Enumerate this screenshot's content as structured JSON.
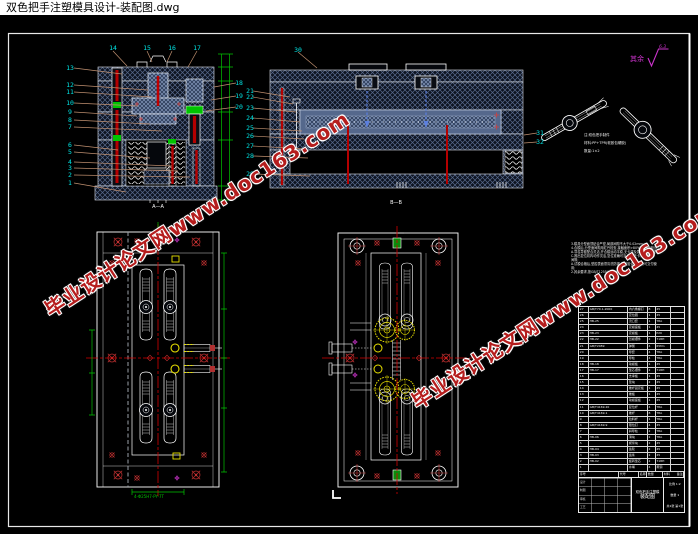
{
  "window": {
    "title": "双色把手注塑模具设计-装配图.dwg"
  },
  "watermark": {
    "text": "毕业设计论文网www.doc163.com"
  },
  "colors": {
    "background": "#000000",
    "titlebar_bg": "#ffffff",
    "hatch_steel": "#56688a",
    "core_blue": "#55688c",
    "callout_cyan": "#00e5e5",
    "leader_tan": "#c09070",
    "dimension_green": "#00c400",
    "centerline_red": "#d40000",
    "bolt_red": "#b40000",
    "slide_yellow": "#e8e000",
    "roughness_magenta": "#cc33cc",
    "watermark_red": "#b51d1d"
  },
  "roughness": {
    "prefix": "其余",
    "value": "6.3"
  },
  "handle_notes": [
    "注:双色把手制件",
    "材料:PP+TPR(软胶包硬胶)",
    "数量:1×2"
  ],
  "view_labels": {
    "front": "A—A",
    "side": "B—B"
  },
  "green_note": "4-Φ25H7-PY-7T",
  "callouts": {
    "left_column": [
      "13",
      "12",
      "11",
      "10",
      "9",
      "8",
      "7",
      "6",
      "5",
      "4",
      "3",
      "2",
      "1"
    ],
    "top_row": [
      "14",
      "15",
      "16",
      "17"
    ],
    "mid_left": [
      "18",
      "19",
      "20"
    ],
    "mid_right": [
      "21",
      "22",
      "23",
      "24",
      "25",
      "26",
      "27",
      "28",
      "29"
    ],
    "side_view_top": "30",
    "side_view_right": [
      "31",
      "32"
    ]
  },
  "tech_notes": {
    "lines": [
      "3.模具分型面须贴合严密,局部间隙不大于0.02mm;",
      "4.合模后,分型面间隙用红丹检查,接触面积>80%(涂红丹检查);",
      "A.导柱导套配合灵活,开合模运动平稳,无卡滞及异常噪音现象;",
      "C.推出复位机构动作灵活,复位准确可靠,推杆无卡滞现象;",
      "  间隙;",
      "A.试模合格后,型腔表面须清洗防锈,经检验合格后 方可交付使",
      "用;",
      "2.其余要求,按GB/T12554-2006执行."
    ]
  },
  "parts_table": {
    "headers": [
      "序号",
      "代号",
      "名称",
      "数量",
      "材料",
      "备注"
    ],
    "rows": [
      [
        "27",
        "GB/T70.1-2000",
        "内六角螺钉",
        "8",
        "45",
        ""
      ],
      [
        "26",
        "",
        "定位圈",
        "1",
        "45",
        ""
      ],
      [
        "25",
        "HB-25",
        "浇口套",
        "1",
        "T8A",
        ""
      ],
      [
        "24",
        "",
        "定模座板",
        "1",
        "45",
        ""
      ],
      [
        "23",
        "HB-23",
        "定模板",
        "1",
        "P20",
        ""
      ],
      [
        "22",
        "HB-22",
        "凹模镶件",
        "2",
        "718H",
        ""
      ],
      [
        "21",
        "GB/T2089",
        "弹簧",
        "4",
        "65Mn",
        ""
      ],
      [
        "20",
        "",
        "导套",
        "4",
        "T8A",
        ""
      ],
      [
        "19",
        "",
        "导柱",
        "4",
        "T8A",
        ""
      ],
      [
        "18",
        "HB-18",
        "动模板",
        "1",
        "45",
        ""
      ],
      [
        "17",
        "HB-17",
        "型芯镶件",
        "2",
        "718H",
        ""
      ],
      [
        "16",
        "",
        "支承板",
        "1",
        "45",
        ""
      ],
      [
        "15",
        "",
        "垫块",
        "2",
        "45",
        ""
      ],
      [
        "14",
        "",
        "推杆固定板",
        "1",
        "45",
        ""
      ],
      [
        "13",
        "",
        "推板",
        "1",
        "45",
        ""
      ],
      [
        "12",
        "",
        "动模座板",
        "1",
        "45",
        ""
      ],
      [
        "11",
        "GB/T4169.20",
        "复位杆",
        "4",
        "T8A",
        ""
      ],
      [
        "10",
        "GB/T4169.1",
        "推杆",
        "8",
        "T8A",
        ""
      ],
      [
        "9",
        "",
        "拉料杆",
        "1",
        "T8A",
        ""
      ],
      [
        "8",
        "GB/T4169.9",
        "限位钉",
        "4",
        "45",
        ""
      ],
      [
        "7",
        "",
        "斜导柱",
        "2",
        "T8A",
        ""
      ],
      [
        "6",
        "HB-06",
        "滑块",
        "2",
        "T8A",
        ""
      ],
      [
        "5",
        "",
        "楔紧块",
        "2",
        "45",
        ""
      ],
      [
        "4",
        "HB-04",
        "齿轮",
        "2",
        "45",
        ""
      ],
      [
        "3",
        "HB-03",
        "齿条",
        "2",
        "45",
        ""
      ],
      [
        "2",
        "HB-02",
        "旋转型芯",
        "2",
        "718H",
        ""
      ],
      [
        "1",
        "",
        "水嘴",
        "4",
        "黄铜",
        ""
      ]
    ]
  },
  "title_block": {
    "product": "双色把手注塑模",
    "drawing": "装配图",
    "scale": "比例 1:2",
    "qty": "数量 1",
    "sheet": "共1张 第1张",
    "roles": [
      "设计",
      "制图",
      "审核",
      "工艺"
    ]
  }
}
